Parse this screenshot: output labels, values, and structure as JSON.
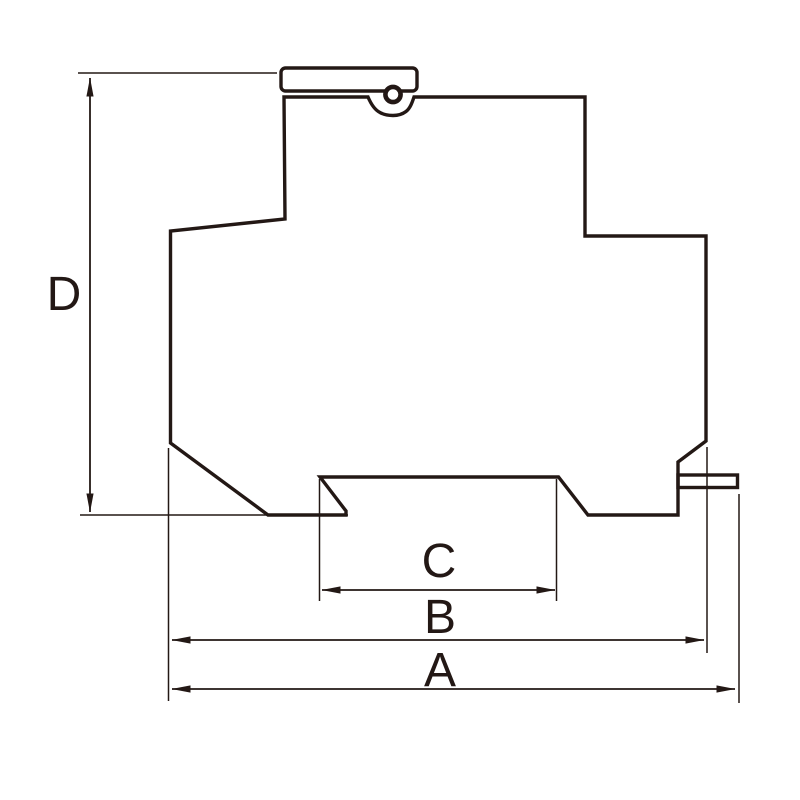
{
  "diagram": {
    "kind": "technical-dimension-drawing",
    "subject": "din-rail-device-side-profile",
    "colors": {
      "background": "#ffffff",
      "line": "#231815"
    },
    "labels": {
      "a": "A",
      "b": "B",
      "c": "C",
      "d": "D"
    },
    "dimensions": [
      {
        "label": "D",
        "orientation": "vertical"
      },
      {
        "label": "C",
        "orientation": "horizontal"
      },
      {
        "label": "B",
        "orientation": "horizontal"
      },
      {
        "label": "A",
        "orientation": "horizontal"
      }
    ]
  }
}
